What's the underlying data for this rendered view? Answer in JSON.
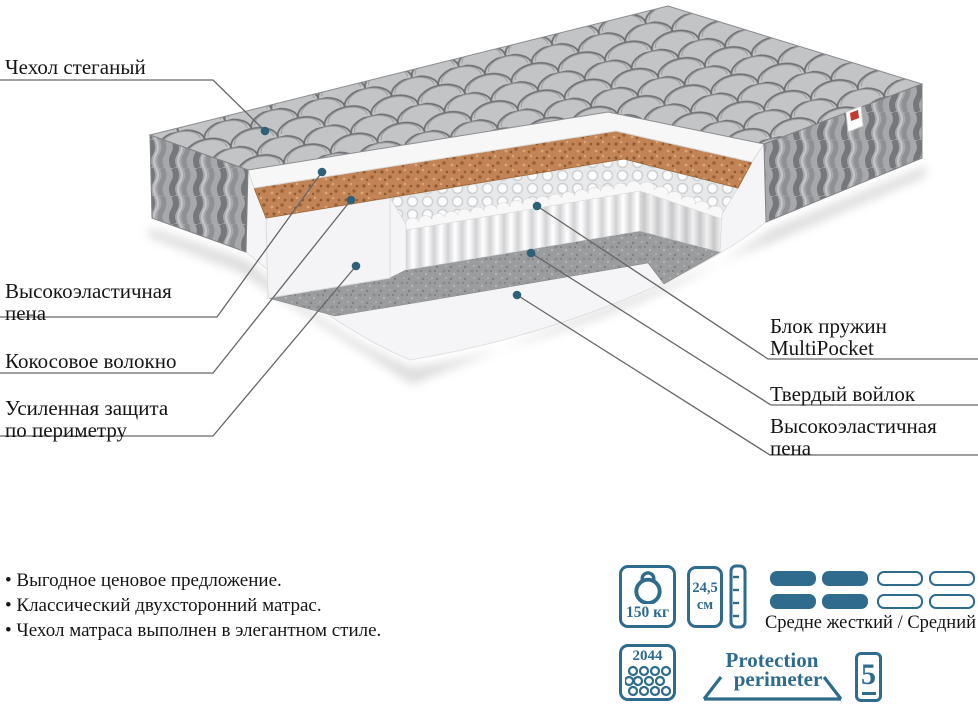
{
  "colors": {
    "accent": "#2e6b8d",
    "callout_dot": "#2e6077",
    "tag_red": "#c23b2e"
  },
  "callouts": [
    {
      "lines": [
        "Чехол стеганый"
      ]
    },
    {
      "lines": [
        "Высокоэластичная",
        "пена"
      ]
    },
    {
      "lines": [
        "Кокосовое волокно"
      ]
    },
    {
      "lines": [
        "Усиленная защита",
        "по периметру"
      ]
    },
    {
      "lines": [
        "Блок пружин",
        "MultiPocket"
      ]
    },
    {
      "lines": [
        "Твердый войлок"
      ]
    },
    {
      "lines": [
        "Высокоэластичная",
        "пена"
      ]
    }
  ],
  "features": [
    "Выгодное ценовое предложение.",
    "Классический двухсторонний матрас.",
    "Чехол матраса выполнен в элегантном стиле."
  ],
  "specs": {
    "max_weight": "150 кг",
    "height_value": "24,5",
    "height_unit": "см",
    "firmness_label": "Средне жесткий / Средний",
    "springs_count": "2044",
    "protection_word1": "Protection",
    "protection_word2": "perimeter",
    "warranty_number": "5"
  }
}
